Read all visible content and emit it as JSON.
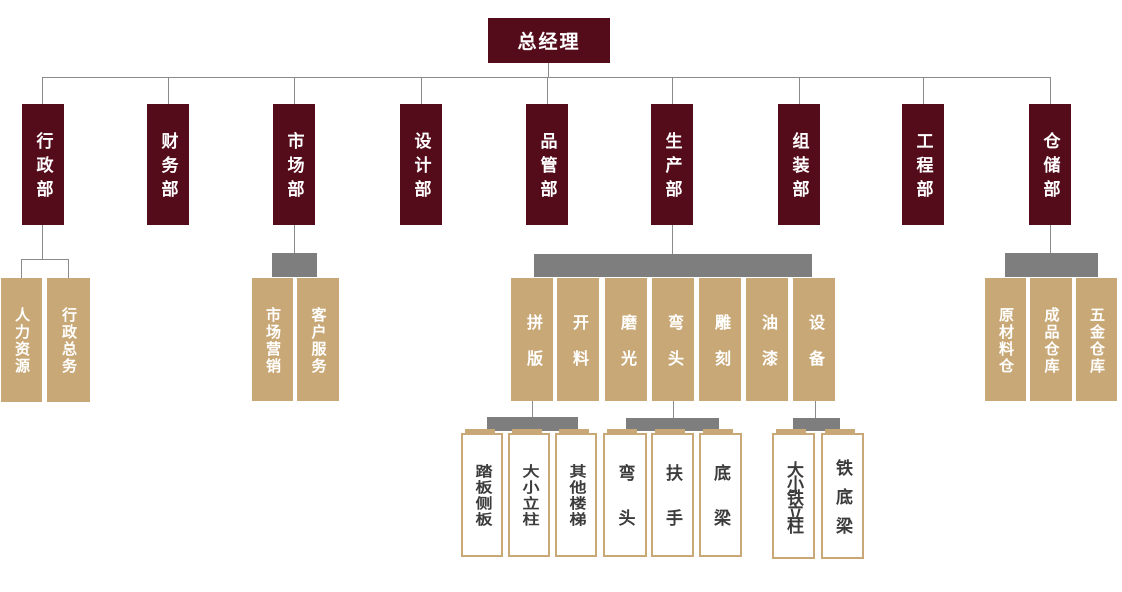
{
  "root": {
    "label": "总经理"
  },
  "departments": [
    {
      "label": "行政部"
    },
    {
      "label": "财务部"
    },
    {
      "label": "市场部"
    },
    {
      "label": "设计部"
    },
    {
      "label": "品管部"
    },
    {
      "label": "生产部"
    },
    {
      "label": "组装部"
    },
    {
      "label": "工程部"
    },
    {
      "label": "仓储部"
    }
  ],
  "level3": {
    "admin": [
      {
        "label": "人力资源"
      },
      {
        "label": "行政总务"
      }
    ],
    "market": [
      {
        "label": "市场营销"
      },
      {
        "label": "客户服务"
      }
    ],
    "production": [
      {
        "label": "拼版"
      },
      {
        "label": "开料"
      },
      {
        "label": "磨光"
      },
      {
        "label": "弯头"
      },
      {
        "label": "雕刻"
      },
      {
        "label": "油漆"
      },
      {
        "label": "设备"
      }
    ],
    "warehouse": [
      {
        "label": "原材料仓"
      },
      {
        "label": "成品仓库"
      },
      {
        "label": "五金仓库"
      }
    ]
  },
  "level4": {
    "pinban": [
      {
        "label": "踏板侧板"
      },
      {
        "label": "大小立柱"
      },
      {
        "label": "其他楼梯"
      }
    ],
    "wantou": [
      {
        "label": "弯头"
      },
      {
        "label": "扶手"
      },
      {
        "label": "底梁"
      }
    ],
    "shebei": [
      {
        "label": "大小铁立柱"
      },
      {
        "label": "铁底梁"
      }
    ]
  },
  "colors": {
    "node_dark_red": "#550C1A",
    "node_tan": "#C9A877",
    "connector_bar_gray": "#7E7E7E",
    "line_gray": "#8A8A8A",
    "white_box_text": "#3C3C3C"
  }
}
